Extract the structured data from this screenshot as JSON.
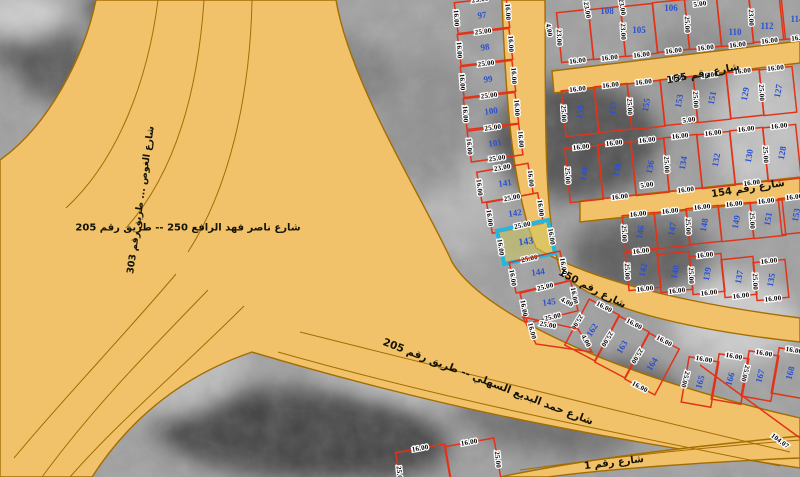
{
  "map": {
    "width": 800,
    "height": 477,
    "colors": {
      "background": "#a0a0a0",
      "road_fill": "#f2c26b",
      "road_edge": "#a36d00",
      "parcel_line": "#e23318",
      "parcel_number": "#2b50d0",
      "dim_text": "#000000",
      "dim_halo": "#ffffff",
      "highlight_stroke": "#25b5dd",
      "highlight_fill": "rgba(205,200,95,0.55)"
    },
    "selected_parcel": {
      "number": "143",
      "dims": [
        "25.00",
        "16.00",
        "25.00",
        "16.00"
      ]
    },
    "bg_blobs": [
      [
        40,
        50,
        70,
        38,
        "#5a5a5a",
        40
      ],
      [
        165,
        55,
        95,
        26,
        "#383838",
        38
      ],
      [
        20,
        15,
        45,
        22,
        "#cfcfcf",
        0
      ],
      [
        255,
        140,
        100,
        55,
        "#6a6a6a",
        15
      ],
      [
        340,
        75,
        55,
        35,
        "#7e7e7e",
        0
      ],
      [
        300,
        240,
        90,
        45,
        "#8f8f8f",
        10
      ],
      [
        575,
        140,
        85,
        60,
        "#525252",
        0
      ],
      [
        640,
        255,
        70,
        40,
        "#5e5e5e",
        0
      ],
      [
        700,
        60,
        55,
        35,
        "#8a8a8a",
        0
      ],
      [
        762,
        130,
        50,
        70,
        "#c2c2c2",
        0
      ],
      [
        735,
        320,
        60,
        45,
        "#cccccc",
        0
      ],
      [
        385,
        330,
        115,
        60,
        "#c6c6c6",
        20
      ],
      [
        300,
        435,
        150,
        45,
        "#454545",
        5
      ],
      [
        545,
        420,
        90,
        35,
        "#6f6f6f",
        10
      ],
      [
        160,
        360,
        85,
        55,
        "#bdbdbd",
        0
      ],
      [
        90,
        255,
        55,
        45,
        "#989898",
        0
      ],
      [
        460,
        200,
        40,
        60,
        "#b5b5b5",
        0
      ],
      [
        620,
        390,
        70,
        30,
        "#585858",
        12
      ],
      [
        430,
        120,
        45,
        70,
        "#909090",
        0
      ]
    ],
    "roads": [
      "M96,0 C84,58 48,126 0,160 L0,477 L92,477 C130,418 182,376 252,352 C420,402 560,432 800,468 L800,418 C600,372 480,310 452,262 C424,200 350,84 336,0 Z",
      "M500,477 C590,458 680,448 800,436 L800,458 C700,462 600,470 548,477 Z",
      "M502,0 C506,110 514,195 536,248 C600,285 700,305 800,318 L800,342 C690,330 590,308 560,270 C542,212 546,95 545,0 Z",
      "M552,71 L800,41 L800,63 L554,93 Z",
      "M580,201 L800,177 L800,198 L580,222 Z"
    ],
    "lane_lines": [
      "M158,0 C148,80 118,160 66,208",
      "M204,0 C198,90 176,172 126,228",
      "M252,0 C250,100 228,190 188,252",
      "M300,332 C460,372 620,412 790,452",
      "M278,352 C440,398 600,430 780,466",
      "M244,306 C180,370 120,420 70,477",
      "M208,290 C150,350 95,405 42,477",
      "M176,274 C120,340 62,400 14,458",
      "M520,470 C620,456 700,448 800,440"
    ],
    "street_labels": [
      {
        "t": "شارع رقم 155",
        "x": 703,
        "y": 74,
        "r": -11,
        "fs": 10
      },
      {
        "t": "شارع رقم 154",
        "x": 748,
        "y": 189,
        "r": -9,
        "fs": 10
      },
      {
        "t": "شارع رقم 150",
        "x": 592,
        "y": 289,
        "r": 27,
        "fs": 10
      },
      {
        "t": "شارع رقم 1",
        "x": 614,
        "y": 463,
        "r": -7,
        "fs": 10
      },
      {
        "t": "شارع حمد البديع السهلي  --  طريق رقم 205",
        "x": 488,
        "y": 382,
        "r": 21,
        "fs": 10.5
      },
      {
        "t": "شارع ناصر فهد الرافع 250  --  طريق رقم 205",
        "x": 188,
        "y": 228,
        "r": 0,
        "fs": 10
      },
      {
        "t": "شارع الغوص ... طريق رقم 303",
        "x": 141,
        "y": 200,
        "r": -82,
        "fs": 9.5
      }
    ],
    "parcel_groups": [
      {
        "name": "left-column",
        "w": 52,
        "h": 31,
        "r": -8,
        "nr": -8,
        "parcels": [
          {
            "n": "97",
            "x": 482,
            "y": 15,
            "r": -7,
            "dt": "25.00",
            "ds": "16.00",
            "dr": "16.00"
          },
          {
            "n": "98",
            "x": 485,
            "y": 47,
            "r": -7,
            "dt": "25.00",
            "ds": "16.00",
            "dr": "16.00"
          },
          {
            "n": "99",
            "x": 488,
            "y": 79,
            "r": -7,
            "dt": "25.00",
            "ds": "16.00",
            "dr": "16.00"
          },
          {
            "n": "100",
            "x": 491,
            "y": 111,
            "r": -7,
            "dt": "25.00",
            "ds": "16.00",
            "dr": "16.00"
          },
          {
            "n": "101",
            "x": 495,
            "y": 143,
            "r": -8,
            "dt": "25.00",
            "db": "25.00",
            "ds": "16.00",
            "dr": "16.00"
          },
          {
            "n": "141",
            "x": 505,
            "y": 183,
            "r": -10,
            "dt": "23.00",
            "ds": "16.00",
            "dr": "16.00"
          },
          {
            "n": "142",
            "x": 515,
            "y": 213,
            "r": -11,
            "dt": "25.00",
            "ds": "16.00",
            "dr": "16.00"
          },
          {
            "n": "143",
            "x": 526,
            "y": 242,
            "r": -12,
            "h": 34,
            "hl": 1,
            "dt": "25.00",
            "db": "25.00",
            "ds": "16.00",
            "dr": "16.00"
          },
          {
            "n": "144",
            "x": 538,
            "y": 272,
            "r": -13,
            "ds": "16.00",
            "dr": "16.00"
          },
          {
            "n": "145",
            "x": 549,
            "y": 302,
            "r": -14,
            "dt": "25.00",
            "db": "25.00",
            "ds": "16.00",
            "dr": "16.00"
          }
        ]
      },
      {
        "name": "block-north-of-155",
        "w": 32,
        "h": 50,
        "r": -6,
        "nr": 0,
        "parcels": [
          {
            "n": "",
            "x": 575,
            "y": 36,
            "ds": "23.00",
            "db": "16.00"
          },
          {
            "n": "108",
            "x": 607,
            "y": 33,
            "ny": -22,
            "db": "16.00"
          },
          {
            "n": "105",
            "x": 639,
            "y": 30,
            "ds": "23.00",
            "db": "16.00"
          },
          {
            "n": "106",
            "x": 671,
            "y": 26,
            "ny": -18,
            "db": "16.00"
          },
          {
            "n": "",
            "x": 703,
            "y": 23,
            "ds": "25.00",
            "db": "16.00"
          },
          {
            "n": "110",
            "x": 735,
            "y": 20,
            "ny": 12,
            "db": "16.00"
          },
          {
            "n": "112",
            "x": 767,
            "y": 16,
            "ny": 10,
            "ds": "23.00",
            "db": "16.00"
          },
          {
            "n": "114",
            "x": 797,
            "y": 13,
            "ny": 6,
            "db": "16.00"
          }
        ]
      },
      {
        "name": "block-155-154-row1",
        "w": 33,
        "h": 46,
        "r": -6,
        "nr": -80,
        "parcels": [
          {
            "n": "159",
            "x": 580,
            "y": 112,
            "dt": "16.00",
            "ds": "25.00"
          },
          {
            "n": "157",
            "x": 613,
            "y": 108,
            "dt": "16.00"
          },
          {
            "n": "155",
            "x": 646,
            "y": 105,
            "dt": "16.00",
            "ds": "25.00"
          },
          {
            "n": "153",
            "x": 679,
            "y": 101,
            "dt": "16.00"
          },
          {
            "n": "151",
            "x": 712,
            "y": 98,
            "dt": "16.00",
            "ds": "25.00"
          },
          {
            "n": "129",
            "x": 745,
            "y": 94,
            "dt": "16.00"
          },
          {
            "n": "127",
            "x": 778,
            "y": 91,
            "dt": "16.00",
            "ds": "25.00"
          }
        ]
      },
      {
        "name": "block-155-154-row2",
        "w": 33,
        "h": 54,
        "r": -6,
        "nr": -80,
        "parcels": [
          {
            "n": "140",
            "x": 584,
            "y": 174,
            "dt": "16.00",
            "ds": "25.00"
          },
          {
            "n": "138",
            "x": 617,
            "y": 170,
            "dt": "16.00",
            "db": "16.00"
          },
          {
            "n": "136",
            "x": 650,
            "y": 167,
            "dt": "16.00"
          },
          {
            "n": "134",
            "x": 683,
            "y": 163,
            "dt": "16.00",
            "db": "16.00",
            "ds": "25.00"
          },
          {
            "n": "132",
            "x": 716,
            "y": 160,
            "dt": "16.00"
          },
          {
            "n": "130",
            "x": 749,
            "y": 156,
            "dt": "16.00",
            "db": "16.00"
          },
          {
            "n": "128",
            "x": 782,
            "y": 153,
            "dt": "16.00",
            "ds": "25.00"
          }
        ]
      },
      {
        "name": "block-154-150-row1",
        "w": 32,
        "h": 36,
        "r": -6,
        "nr": -80,
        "parcels": [
          {
            "n": "146",
            "x": 640,
            "y": 232,
            "dt": "16.00",
            "ds": "25.00"
          },
          {
            "n": "147",
            "x": 672,
            "y": 229,
            "dt": "16.00"
          },
          {
            "n": "148",
            "x": 704,
            "y": 225,
            "dt": "16.00",
            "ds": "25.00"
          },
          {
            "n": "149",
            "x": 736,
            "y": 222,
            "dt": "16.00"
          },
          {
            "n": "151",
            "x": 768,
            "y": 219,
            "dt": "16.00",
            "ds": "25.00"
          },
          {
            "n": "153",
            "x": 796,
            "y": 215,
            "dt": "16.00"
          }
        ]
      },
      {
        "name": "block-154-150-row2",
        "w": 32,
        "h": 38,
        "r": -6,
        "nr": -80,
        "parcels": [
          {
            "n": "142",
            "x": 643,
            "y": 270,
            "dt": "16.00",
            "db": "16.00",
            "ds": "25.00"
          },
          {
            "n": "140",
            "x": 675,
            "y": 272,
            "db": "16.00"
          },
          {
            "n": "139",
            "x": 707,
            "y": 274,
            "dt": "16.00",
            "db": "16.00",
            "ds": "25.00"
          },
          {
            "n": "137",
            "x": 739,
            "y": 277,
            "db": "16.00"
          },
          {
            "n": "135",
            "x": 771,
            "y": 280,
            "dt": "16.00",
            "db": "16.00",
            "ds": "25.00"
          }
        ]
      },
      {
        "name": "block-south-of-150",
        "w": 34,
        "h": 52,
        "r": 28,
        "nr": -58,
        "parcels": [
          {
            "n": "162",
            "x": 592,
            "y": 330,
            "dt": "16.00",
            "ds": "25.00"
          },
          {
            "n": "163",
            "x": 622,
            "y": 347,
            "dt": "16.00",
            "ds": "25.00"
          },
          {
            "n": "164",
            "x": 652,
            "y": 364,
            "dt": "16.00",
            "db": "16.00",
            "ds": "25.00"
          }
        ]
      },
      {
        "name": "block-bottom-right",
        "w": 30,
        "h": 46,
        "r": 10,
        "nr": -75,
        "parcels": [
          {
            "n": "165",
            "x": 700,
            "y": 382,
            "dt": "16.00",
            "ds": "25.00"
          },
          {
            "n": "166",
            "x": 730,
            "y": 379,
            "dt": "16.00"
          },
          {
            "n": "167",
            "x": 760,
            "y": 376,
            "dt": "16.00",
            "ds": "25.00"
          },
          {
            "n": "168",
            "x": 790,
            "y": 373,
            "dt": "16.00"
          }
        ]
      },
      {
        "name": "block-bottom-partial",
        "w": 50,
        "h": 44,
        "r": -10,
        "nr": 0,
        "parcels": [
          {
            "n": "",
            "x": 424,
            "y": 470,
            "dt": "16.00",
            "ds": "25.00"
          },
          {
            "n": "",
            "x": 473,
            "y": 464,
            "dt": "16.00",
            "dr": "25.00"
          }
        ]
      }
    ],
    "wedges": [
      {
        "pts": "523,317 578,329 592,352 536,344"
      }
    ],
    "extra_dims": [
      [
        "23.00",
        587,
        10,
        80
      ],
      [
        "23.00",
        622,
        7,
        80
      ],
      [
        "4.00",
        549,
        30,
        80
      ],
      [
        "5.00",
        700,
        4,
        -8
      ],
      [
        "5.00",
        689,
        120,
        -8
      ],
      [
        "5.00",
        647,
        185,
        -8
      ],
      [
        "25.00",
        548,
        325,
        10
      ],
      [
        "4.00",
        586,
        341,
        62
      ],
      [
        "16.00",
        532,
        331,
        76
      ],
      [
        "4.00",
        567,
        302,
        28
      ],
      [
        "104.07",
        780,
        441,
        37
      ]
    ],
    "red_lines": [
      [
        700,
        365,
        800,
        438
      ]
    ]
  }
}
